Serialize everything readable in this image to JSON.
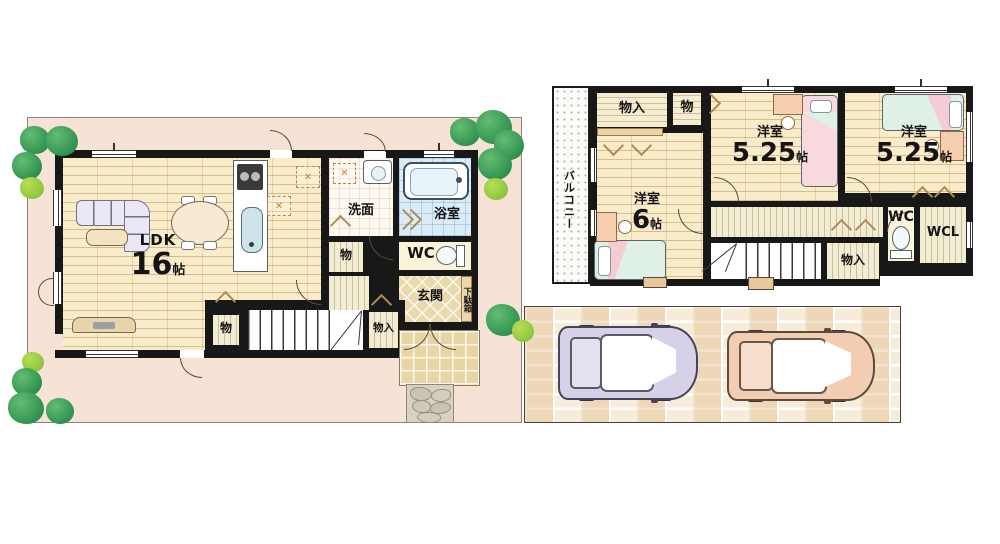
{
  "colors": {
    "wall": "#181818",
    "lot": "#f6e3d5",
    "wood_floor": "#f9ecca",
    "bath_blue": "#dcecf6",
    "tree_green": "#2f9150",
    "car_left": "#d6d1e8",
    "car_right": "#f3cdb2"
  },
  "floor1": {
    "ldk_label": "LDK",
    "ldk_area": "16",
    "ldk_unit": "帖",
    "senmen": "洗面",
    "bath": "浴室",
    "wc": "WC",
    "genkan": "玄関",
    "getabako": "下駄箱",
    "mono_a": "物",
    "mono_b": "物",
    "monoire": "物入"
  },
  "floor2": {
    "balcony": "バルコニー",
    "monoire_top": "物入",
    "mono_top": "物",
    "room6_label": "洋室",
    "room6_area": "6",
    "room6_unit": "帖",
    "room525a_label": "洋室",
    "room525a_area": "5.25",
    "room525a_unit": "帖",
    "room525b_label": "洋室",
    "room525b_area": "5.25",
    "room525b_unit": "帖",
    "wc": "WC",
    "wcl": "WCL",
    "monoire_bottom": "物入"
  }
}
